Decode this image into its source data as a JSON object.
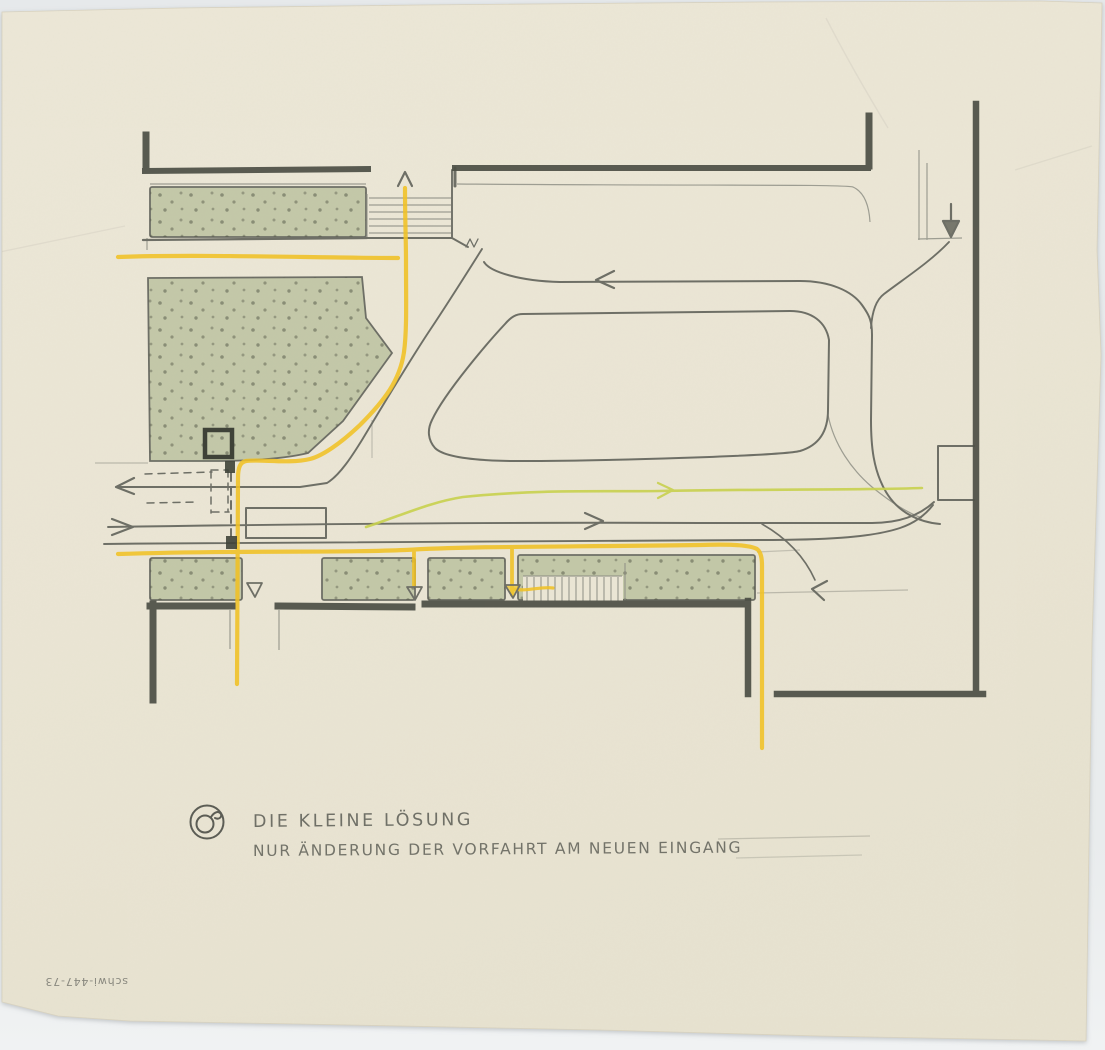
{
  "captions": {
    "line1": "DIE KLEINE LÖSUNG",
    "line2": "NUR ÄNDERUNG DER VORFAHRT AM NEUEN EINGANG",
    "archive_code": "schwi-447-73"
  },
  "palette": {
    "paper": "#ebe6d5",
    "margin": "#e7eaec",
    "pencil_light": "#8f9086",
    "pencil": "#6e6f66",
    "pencil_dark": "#4d5046",
    "green": "#b7bf9b",
    "green_dot": "#4f5343",
    "yellow": "#f0c125",
    "yellow_green": "#c8d04e",
    "text": "#5f6058"
  }
}
